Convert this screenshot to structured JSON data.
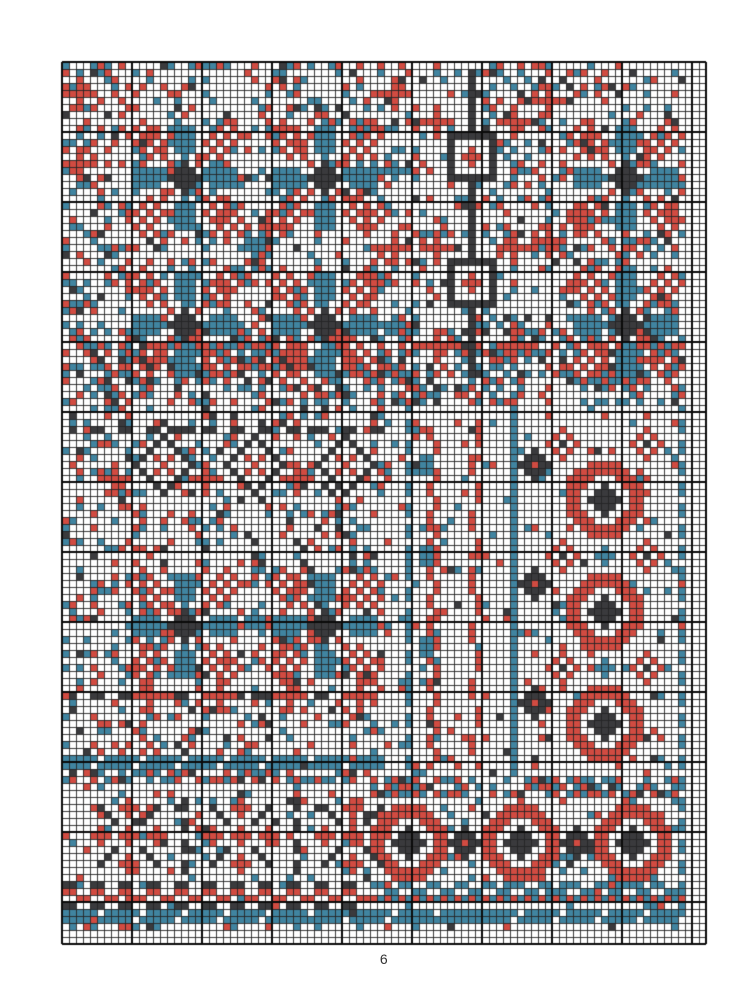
{
  "page": {
    "number": "6"
  },
  "palette": {
    "red": "#d14b41",
    "teal": "#4084a0",
    "dark": "#3a3a3d",
    "white": "#ffffff",
    "grid_minor": "#262626",
    "grid_major": "#0a0a0a",
    "page_bg": "#ffffff",
    "page_number_color": "#333333"
  },
  "grid": {
    "cols": 92,
    "rows": 126,
    "cell_px": 7,
    "major_every": 10,
    "origin_x": 62,
    "origin_y": 62
  },
  "pattern": {
    "speckle_zones": [
      {
        "name": "top-field",
        "c0": 0,
        "r0": 0,
        "c1": 88,
        "r1": 44,
        "density": 0.3
      },
      {
        "name": "transition-band",
        "c0": 0,
        "r0": 38,
        "c1": 88,
        "r1": 48,
        "density": 0.45
      },
      {
        "name": "mid-band-left",
        "c0": 0,
        "r0": 49,
        "c1": 46,
        "r1": 64,
        "density": 0.3
      },
      {
        "name": "pinwheel-field-2",
        "c0": 0,
        "r0": 65,
        "c1": 46,
        "r1": 100,
        "density": 0.26
      },
      {
        "name": "right-panel",
        "c0": 47,
        "r0": 49,
        "c1": 88,
        "r1": 101,
        "density": 0.1
      },
      {
        "name": "flower-band",
        "c0": 0,
        "r0": 101,
        "c1": 43,
        "r1": 123,
        "density": 0.14
      },
      {
        "name": "ring-band",
        "c0": 44,
        "r0": 102,
        "c1": 88,
        "r1": 123,
        "density": 0.16
      },
      {
        "name": "flower-band-border",
        "c0": 0,
        "r0": 101,
        "c1": 43,
        "r1": 102,
        "density": 0.55
      },
      {
        "name": "ring-band-border",
        "c0": 44,
        "r0": 102,
        "c1": 88,
        "r1": 104,
        "density": 0.55
      }
    ],
    "lines": [
      {
        "type": "stem",
        "c": 58,
        "r0": 2,
        "r1": 44
      },
      {
        "type": "dash_row",
        "r": 52,
        "c0": 1,
        "c1": 45
      },
      {
        "type": "dash_row",
        "r": 90,
        "c0": 1,
        "c1": 44
      },
      {
        "type": "dash_row",
        "r": 117,
        "c0": 0,
        "c1": 43
      },
      {
        "type": "dash_row",
        "r": 120,
        "c0": 0,
        "c1": 43
      },
      {
        "type": "h_stripe",
        "r": 99,
        "rows": 2,
        "c0": 0,
        "c1": 45
      },
      {
        "type": "h_stripe",
        "r": 121,
        "rows": 2,
        "c0": 0,
        "c1": 43
      },
      {
        "type": "h_stripe",
        "r": 121,
        "rows": 2,
        "c0": 44,
        "c1": 88
      },
      {
        "type": "zigzag_row",
        "r": 118,
        "c0": 0,
        "c1": 43,
        "color": "red"
      },
      {
        "type": "zigzag_row",
        "r": 117,
        "c0": 44,
        "c1": 88,
        "color": "teal"
      },
      {
        "type": "checker_row",
        "r": 119,
        "c0": 44,
        "c1": 88
      },
      {
        "type": "v_line",
        "c": 49,
        "r0": 49,
        "r1": 101,
        "color": "teal",
        "dotted": true
      },
      {
        "type": "v_line",
        "c": 88,
        "r0": 49,
        "r1": 120,
        "color": "teal",
        "dotted": true
      },
      {
        "type": "v_line",
        "c": 64,
        "r0": 50,
        "r1": 101,
        "color": "teal",
        "dotted": false
      },
      {
        "type": "v_line",
        "c": 17,
        "r0": 104,
        "r1": 116,
        "color": "dark",
        "dotted": true
      },
      {
        "type": "v_line",
        "c": 33,
        "r0": 104,
        "r1": 116,
        "color": "dark",
        "dotted": true
      },
      {
        "type": "v_zigzag",
        "c": 52,
        "r0": 52,
        "r1": 100,
        "color": "red"
      },
      {
        "type": "v_dots",
        "c": 58,
        "r0": 52,
        "r1": 100,
        "color": "red"
      }
    ],
    "chains": [
      {
        "c0": 17,
        "r0": 16,
        "c1": 37,
        "r1": 37
      },
      {
        "c0": 37,
        "r0": 16,
        "c1": 17,
        "r1": 37
      },
      {
        "c0": 80,
        "r0": 20,
        "c1": 80,
        "r1": 33
      },
      {
        "c0": 17,
        "r0": 80,
        "c1": 37,
        "r1": 80
      }
    ],
    "motifs": [
      {
        "type": "pinwheel",
        "positions": [
          [
            17,
            16
          ],
          [
            37,
            16
          ],
          [
            80,
            16
          ],
          [
            17,
            37
          ],
          [
            37,
            37
          ],
          [
            80,
            37
          ],
          [
            17,
            80
          ],
          [
            37,
            80
          ]
        ]
      },
      {
        "type": "eye_square",
        "positions": [
          [
            58,
            13
          ],
          [
            58,
            31
          ]
        ]
      },
      {
        "type": "eye_diamond",
        "positions": [
          [
            14,
            57
          ],
          [
            27,
            57
          ],
          [
            40,
            57
          ]
        ]
      },
      {
        "type": "red_cross",
        "positions": [
          [
            53,
            8
          ],
          [
            64,
            8
          ],
          [
            53,
            26
          ],
          [
            64,
            26
          ],
          [
            53,
            40
          ],
          [
            64,
            40
          ],
          [
            69,
            5
          ],
          [
            69,
            25
          ],
          [
            47,
            4
          ],
          [
            47,
            26
          ],
          [
            7,
            59
          ],
          [
            20,
            59
          ],
          [
            33,
            59
          ],
          [
            12,
            90
          ],
          [
            22,
            90
          ],
          [
            32,
            90
          ],
          [
            42,
            90
          ],
          [
            2,
            4
          ],
          [
            2,
            14
          ]
        ]
      },
      {
        "type": "teal_diamond",
        "positions": [
          [
            27,
            26
          ],
          [
            47,
            15
          ],
          [
            47,
            37
          ],
          [
            27,
            79
          ],
          [
            77,
            70
          ],
          [
            77,
            86
          ]
        ]
      },
      {
        "type": "black_diamond",
        "positions": [
          [
            67,
            57
          ],
          [
            67,
            74
          ],
          [
            67,
            91
          ],
          [
            57,
            111
          ],
          [
            73,
            111
          ]
        ]
      },
      {
        "type": "big_ring",
        "positions": [
          [
            77,
            62
          ],
          [
            77,
            78
          ],
          [
            77,
            94
          ],
          [
            49,
            111
          ],
          [
            65,
            111
          ],
          [
            81,
            111
          ]
        ]
      },
      {
        "type": "small_ring",
        "positions": [
          [
            71,
            54
          ],
          [
            83,
            54
          ],
          [
            71,
            70
          ],
          [
            83,
            70
          ],
          [
            71,
            86
          ],
          [
            83,
            86
          ]
        ]
      },
      {
        "type": "flower",
        "positions": [
          [
            9,
            110
          ],
          [
            25,
            110
          ],
          [
            41,
            110
          ]
        ]
      },
      {
        "type": "teal_block",
        "positions": [
          [
            51,
            57
          ],
          [
            51,
            70
          ],
          [
            51,
            83
          ]
        ]
      }
    ]
  }
}
